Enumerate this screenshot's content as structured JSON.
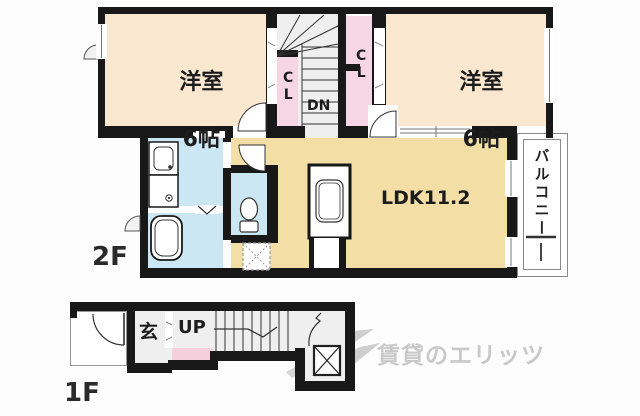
{
  "colors": {
    "wall_black": "#181818",
    "room_cream": "#fae7d0",
    "closet_pink": "#f6d5e4",
    "ldk_tan": "#f3dfa6",
    "water_blue": "#cbe7f4",
    "stair_gray": "#efefef",
    "pink_1f": "#f6cfdc",
    "watermark_gray": "#c9c9c9"
  },
  "floor2": {
    "label": "2F",
    "bedroom_left_name": "洋室",
    "bedroom_left_size": "6帖",
    "bedroom_right_name": "洋室",
    "bedroom_right_size": "6帖",
    "ldk_label": "LDK11.2",
    "balcony_label": "バルコニー",
    "closet_left_label": "CL",
    "closet_right_label": "CL",
    "stairs_label": "DN"
  },
  "floor1": {
    "label": "1F",
    "entrance_label": "玄",
    "stairs_label": "UP"
  },
  "watermark": {
    "text": "賃貸のエリッツ"
  }
}
